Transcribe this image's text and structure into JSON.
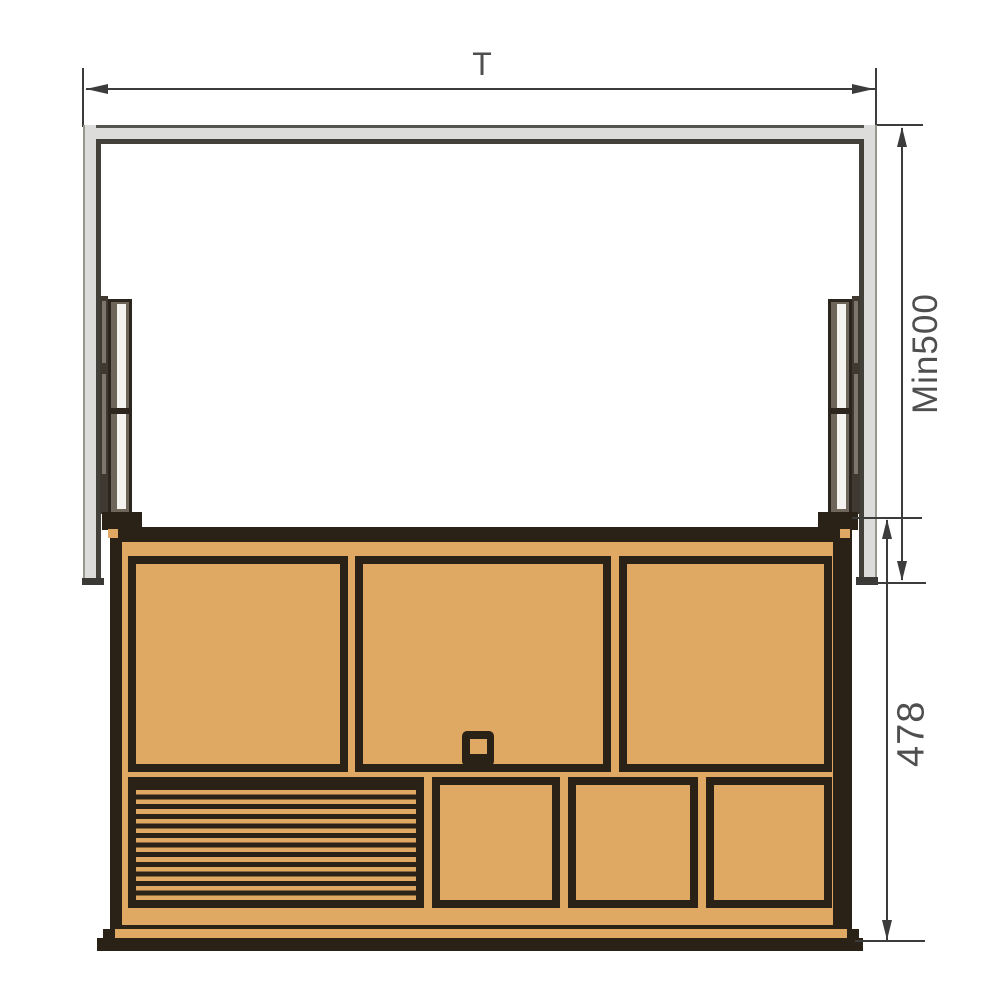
{
  "labels": {
    "total_width": "T",
    "min_depth": "Min500",
    "unit_height": "478"
  },
  "colors": {
    "background": "#ffffff",
    "wood": "#dfa963",
    "outline": "#2b2217",
    "cabinet_fill": "#dcdcda",
    "cabinet_edge": "#97968f",
    "cabinet_inner_line": "#43403a",
    "rail_light": "#f4f3ef",
    "rail_mid": "#6e665b",
    "rail_dark": "#3f3931",
    "dimension_line": "#3c3c3c",
    "text": "#4f4f4f"
  }
}
